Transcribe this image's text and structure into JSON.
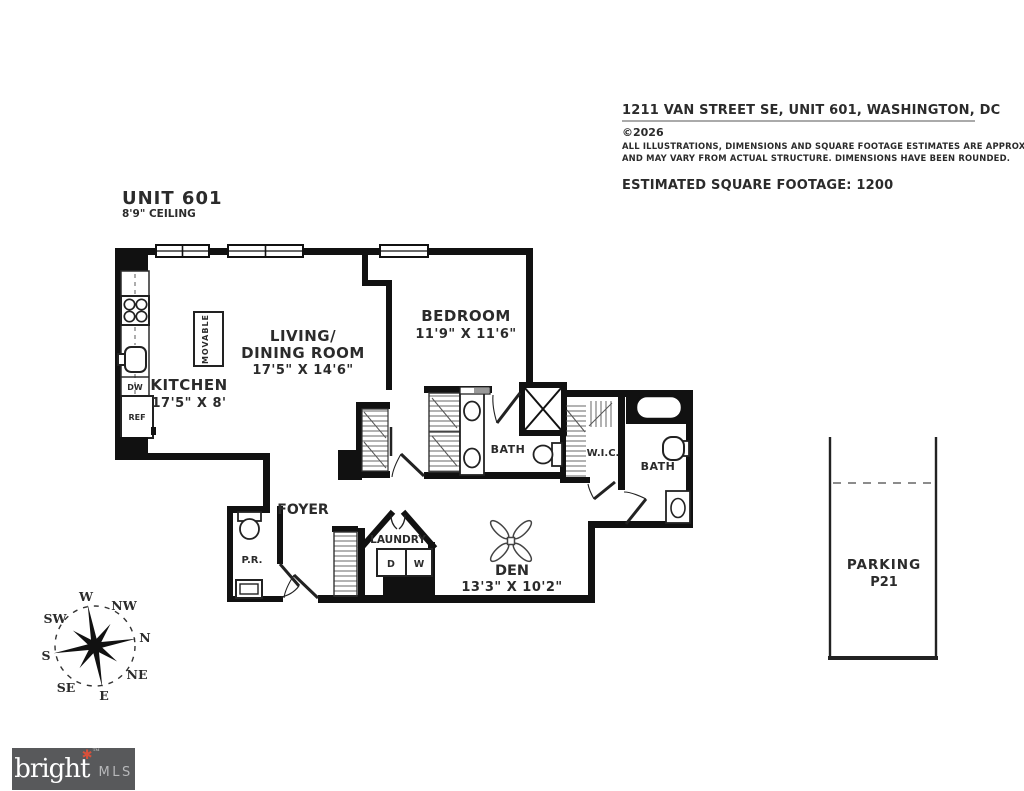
{
  "header": {
    "address": "1211 VAN STREET SE, UNIT 601, WASHINGTON, DC",
    "copyright": "©2026",
    "disclaimer1": "ALL ILLUSTRATIONS, DIMENSIONS AND SQUARE FOOTAGE ESTIMATES ARE APPROXIMATE",
    "disclaimer2": "AND MAY VARY FROM ACTUAL STRUCTURE. DIMENSIONS HAVE BEEN ROUNDED.",
    "sqft": "ESTIMATED SQUARE FOOTAGE: 1200"
  },
  "unit": {
    "title": "UNIT 601",
    "ceiling": "8'9\" CEILING"
  },
  "rooms": {
    "living1": "LIVING/",
    "living2": "DINING ROOM",
    "living_dims": "17'5\" X 14'6\"",
    "kitchen": "KITCHEN",
    "kitchen_dims": "17'5\" X 8'",
    "bedroom": "BEDROOM",
    "bedroom_dims": "11'9\" X 11'6\"",
    "den": "DEN",
    "den_dims": "13'3\" X 10'2\"",
    "bath1": "BATH",
    "bath2": "BATH",
    "wic": "W.I.C.",
    "foyer": "FOYER",
    "pr": "P.R.",
    "laundry": "LAUNDRY",
    "movable": "MOVABLE"
  },
  "appliances": {
    "dw": "DW",
    "ref": "REF",
    "dryer": "D",
    "washer": "W"
  },
  "parking": {
    "label": "PARKING",
    "space": "P21"
  },
  "compass": {
    "w": "W",
    "nw": "NW",
    "n": "N",
    "ne": "NE",
    "e": "E",
    "se": "SE",
    "s": "S",
    "sw": "SW"
  },
  "logo": {
    "brand": "bright",
    "tm": "TM",
    "mls": "MLS"
  },
  "colors": {
    "wall": "#111111",
    "text": "#2b2b2b",
    "hatch": "#555555",
    "logo_bg": "#58595b",
    "logo_accent": "#d8503a",
    "logo_mls": "#b7b8ba"
  }
}
